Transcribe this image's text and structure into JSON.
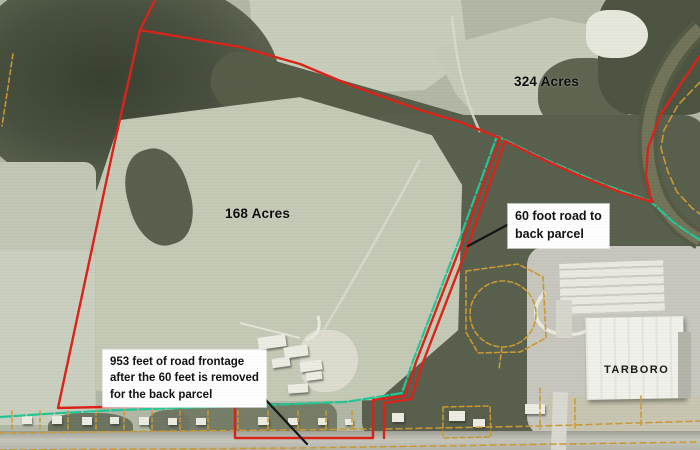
{
  "labels": {
    "acreage_324": "324 Acres",
    "acreage_168": "168 Acres",
    "building_label": "TARBORO"
  },
  "callouts": {
    "road_60ft": "60 foot road to\nback parcel",
    "frontage_953ft": "953 feet of road frontage\nafter the 60 feet is removed\nfor the back parcel"
  },
  "colors": {
    "parcel_boundary": "#dc231a",
    "pipeline": "#25c795",
    "lot_lines": "#cc9a33",
    "leader": "#151515",
    "callout_bg": "#ffffff",
    "callout_text": "#111111"
  },
  "overlays": [
    {
      "name": "lot-lines-row",
      "type": "vlines",
      "color": "#cc9a33",
      "width": 1.5,
      "dash": "4 3",
      "xs": [
        12,
        40,
        68,
        96,
        124,
        152,
        180,
        208,
        238,
        268,
        298,
        326,
        352
      ],
      "y1": 411,
      "y2": 431
    },
    {
      "name": "road-lot-line-north-west",
      "color": "#cc9a33",
      "width": 1.5,
      "dash": "6 4",
      "points": [
        [
          0,
          433
        ],
        [
          372,
          429
        ]
      ]
    },
    {
      "name": "road-lot-line-north-east",
      "color": "#cc9a33",
      "width": 1.5,
      "dash": "6 4",
      "points": [
        [
          386,
          429
        ],
        [
          540,
          426
        ],
        [
          700,
          421
        ]
      ]
    },
    {
      "name": "road-lot-line-south",
      "color": "#cc9a33",
      "width": 1.5,
      "dash": "6 4",
      "points": [
        [
          0,
          450
        ],
        [
          300,
          448
        ],
        [
          700,
          442
        ]
      ]
    },
    {
      "name": "left-edge-lot-line",
      "color": "#cc9a33",
      "width": 1.5,
      "dash": "5 3",
      "points": [
        [
          13,
          54
        ],
        [
          2,
          126
        ]
      ]
    },
    {
      "name": "river-lot-line",
      "color": "#cc9a33",
      "width": 1.6,
      "dash": "7 4",
      "points": [
        [
          700,
          82
        ],
        [
          678,
          105
        ],
        [
          664,
          130
        ],
        [
          661,
          148
        ],
        [
          668,
          172
        ],
        [
          677,
          192
        ],
        [
          692,
          208
        ],
        [
          700,
          214
        ]
      ]
    },
    {
      "name": "woods-parcel-outline",
      "color": "#cc9a33",
      "width": 1.6,
      "dash": "5 3",
      "points": [
        [
          466,
          271
        ],
        [
          518,
          264
        ],
        [
          543,
          277
        ],
        [
          546,
          338
        ],
        [
          520,
          352
        ],
        [
          478,
          353
        ],
        [
          466,
          332
        ],
        [
          466,
          271
        ]
      ]
    },
    {
      "name": "woods-parcel-circle",
      "type": "circle",
      "color": "#cc9a33",
      "width": 1.6,
      "dash": "5 3",
      "cx": 503,
      "cy": 314,
      "r": 33
    },
    {
      "name": "woods-parcel-stub",
      "color": "#cc9a33",
      "width": 1.6,
      "dash": "5 3",
      "points": [
        [
          502,
          347
        ],
        [
          499,
          369
        ]
      ]
    },
    {
      "name": "east-lot-rect",
      "color": "#cc9a33",
      "width": 1.5,
      "dash": "5 3",
      "points": [
        [
          443,
          407
        ],
        [
          490,
          406
        ],
        [
          491,
          437
        ],
        [
          443,
          438
        ],
        [
          443,
          407
        ]
      ]
    },
    {
      "name": "east-lot-line-b",
      "color": "#cc9a33",
      "width": 1.5,
      "dash": "5 3",
      "points": [
        [
          540,
          388
        ],
        [
          540,
          429
        ]
      ]
    },
    {
      "name": "east-lot-line-c",
      "color": "#cc9a33",
      "width": 1.5,
      "dash": "5 3",
      "points": [
        [
          575,
          399
        ],
        [
          575,
          428
        ]
      ]
    },
    {
      "name": "east-lot-line-d",
      "color": "#cc9a33",
      "width": 1.5,
      "dash": "5 3",
      "points": [
        [
          641,
          396
        ],
        [
          641,
          425
        ]
      ]
    },
    {
      "name": "pipeline-green-line",
      "color": "#25c795",
      "width": 2.2,
      "dash": "11 3",
      "points": [
        [
          0,
          417
        ],
        [
          60,
          413
        ],
        [
          120,
          410
        ],
        [
          235,
          406
        ],
        [
          345,
          402
        ],
        [
          371,
          398
        ],
        [
          402,
          393
        ],
        [
          413,
          361
        ],
        [
          460,
          238
        ],
        [
          497,
          136
        ],
        [
          540,
          157
        ],
        [
          600,
          183
        ],
        [
          650,
          201
        ],
        [
          660,
          210
        ],
        [
          672,
          221
        ],
        [
          686,
          231
        ],
        [
          700,
          240
        ]
      ]
    },
    {
      "name": "parcel-168-boundary",
      "color": "#dc231a",
      "width": 2.4,
      "points": [
        [
          155,
          0
        ],
        [
          140,
          30
        ],
        [
          113,
          150
        ],
        [
          58,
          408
        ],
        [
          150,
          406
        ],
        [
          235,
          403
        ],
        [
          235,
          438
        ],
        [
          373,
          438
        ],
        [
          373,
          400
        ],
        [
          405,
          396
        ],
        [
          416,
          362
        ],
        [
          463,
          240
        ],
        [
          500,
          138
        ],
        [
          460,
          122
        ],
        [
          420,
          110
        ],
        [
          350,
          85
        ],
        [
          300,
          64
        ],
        [
          240,
          47
        ],
        [
          140,
          30
        ]
      ]
    },
    {
      "name": "road-corridor-east-line",
      "color": "#dc231a",
      "width": 2.4,
      "points": [
        [
          384,
          438
        ],
        [
          384,
          403
        ],
        [
          411,
          399
        ],
        [
          422,
          365
        ],
        [
          469,
          243
        ],
        [
          505,
          141
        ]
      ]
    },
    {
      "name": "parcel-324-south-boundary",
      "color": "#dc231a",
      "width": 2.4,
      "points": [
        [
          505,
          141
        ],
        [
          540,
          158
        ],
        [
          580,
          176
        ],
        [
          620,
          192
        ],
        [
          652,
          202
        ]
      ]
    },
    {
      "name": "river-red-boundary",
      "color": "#dc231a",
      "width": 2.4,
      "points": [
        [
          700,
          56
        ],
        [
          682,
          82
        ],
        [
          661,
          114
        ],
        [
          648,
          148
        ],
        [
          646,
          176
        ],
        [
          650,
          195
        ],
        [
          652,
          202
        ]
      ]
    },
    {
      "name": "leader-60-foot-road",
      "color": "#151515",
      "width": 2.2,
      "points": [
        [
          509,
          224
        ],
        [
          468,
          246
        ]
      ]
    },
    {
      "name": "leader-953-feet",
      "color": "#151515",
      "width": 2.2,
      "points": [
        [
          248,
          381
        ],
        [
          307,
          444
        ]
      ]
    }
  ]
}
